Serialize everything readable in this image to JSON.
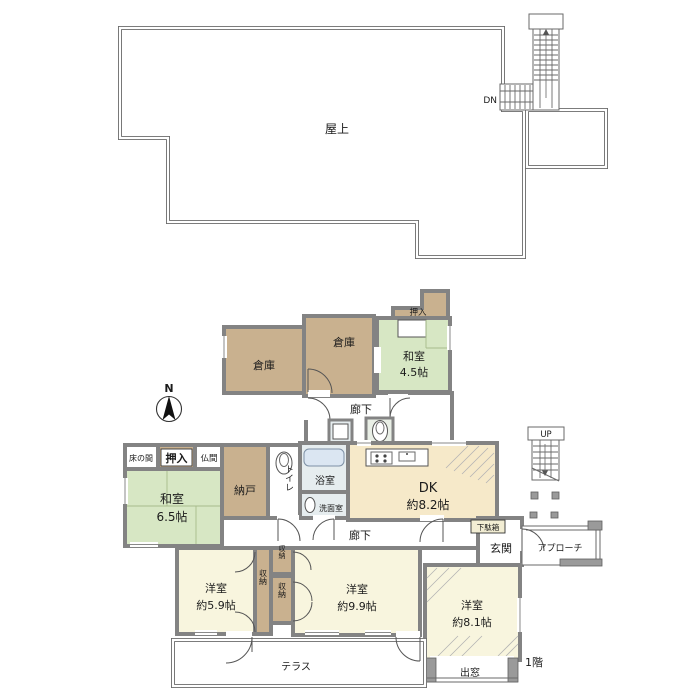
{
  "colors": {
    "wall": "#838383",
    "line": "#6a6a6a",
    "tan": "#c9b18f",
    "green": "#d7e7c4",
    "cream": "#f6e9c9",
    "yellow": "#f8f5de",
    "bath": "#e6edef",
    "tub": "#dbe6f2",
    "chip": "#f2edd3",
    "niche": "#e9efe6"
  },
  "labels": {
    "roof": "屋上",
    "dn": "DN",
    "up": "UP",
    "north": "N",
    "warehouse_a": "倉庫",
    "warehouse_b": "倉庫",
    "washitsu45_name": "和室",
    "washitsu45_size": "4.5帖",
    "oshiire_mid": "押入",
    "hallway_mid": "廊下",
    "tokonoma": "床の間",
    "oshiire": "押入",
    "butsuma": "仏間",
    "washitsu65_name": "和室",
    "washitsu65_size": "6.5帖",
    "nando": "納戸",
    "toilet": "トイレ",
    "bath": "浴室",
    "washroom": "洗面室",
    "dk_name": "DK",
    "dk_size": "約8.2帖",
    "hallway_low": "廊下",
    "getabako": "下駄箱",
    "genkan": "玄関",
    "approach": "アプローチ",
    "storage_tall": "収納",
    "storage_top": "収納",
    "storage_mid": "収納",
    "west59_name": "洋室",
    "west59_size": "約5.9帖",
    "west99_name": "洋室",
    "west99_size": "約9.9帖",
    "west81_name": "洋室",
    "west81_size": "約8.1帖",
    "demado": "出窓",
    "terrace": "テラス",
    "floor1": "1階"
  }
}
